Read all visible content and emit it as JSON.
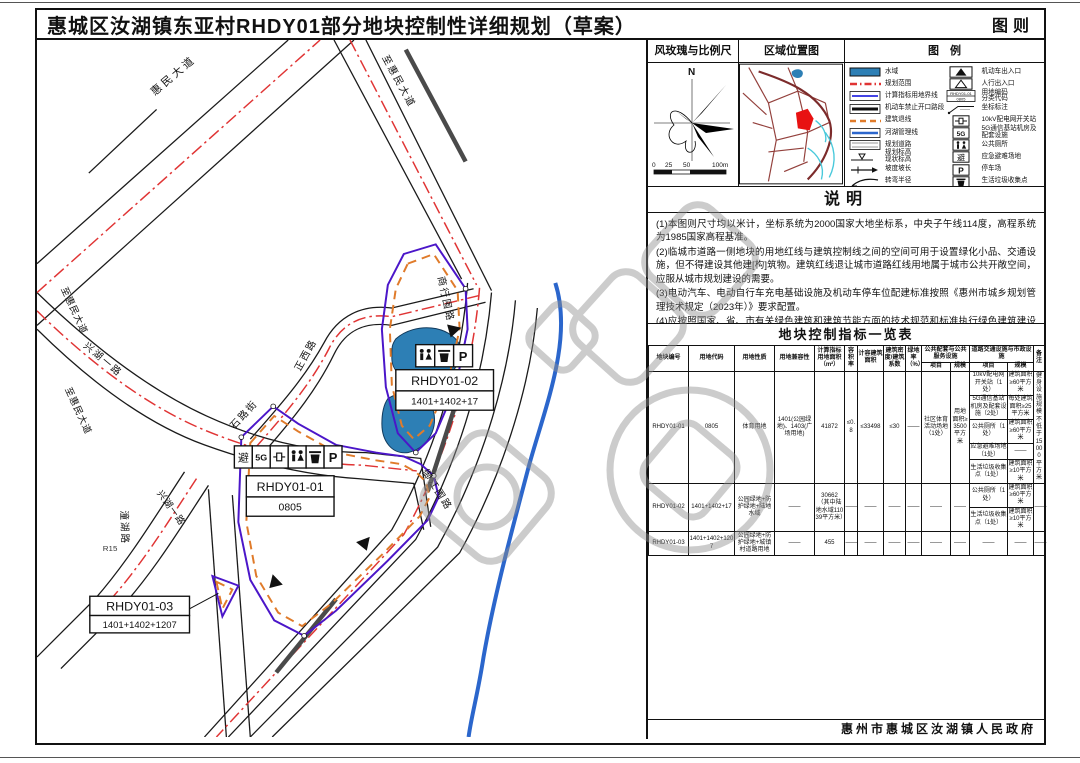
{
  "title": "惠城区汝湖镇东亚村RHDY01部分地块控制性详细规划（草案）",
  "sheet_label": "图则",
  "footer": "惠州市惠城区汝湖镇人民政府",
  "panels": {
    "windrose_title": "风玫瑰与比例尺",
    "location_title": "区域位置图",
    "legend_title": "图　例",
    "north_label": "N",
    "scale_ticks": [
      "0",
      "25",
      "50",
      "100m"
    ]
  },
  "legend": {
    "left": [
      {
        "label": "水域"
      },
      {
        "label": "规划范围"
      },
      {
        "label": "计算指标用地界线"
      },
      {
        "label": "机动车禁止开口路段"
      },
      {
        "label": "建筑退线"
      },
      {
        "label": "河湖管理线"
      },
      {
        "label": "规划道路"
      },
      {
        "label": "规划标高\n现状标高"
      },
      {
        "label": "坡度坡长"
      },
      {
        "label": "转弯半径"
      }
    ],
    "right": [
      {
        "label": "机动车出入口"
      },
      {
        "label": "人行出入口"
      },
      {
        "label": "用地编码\n分类代码"
      },
      {
        "label": "坐标标注"
      },
      {
        "label": "10kV配电网开关站"
      },
      {
        "label": "5G通信基站机房及\n配套设施"
      },
      {
        "label": "公共厕所"
      },
      {
        "label": "应急避难场地"
      },
      {
        "label": "停车场"
      },
      {
        "label": "生活垃圾收集点"
      }
    ],
    "samples": {
      "code_top": "RHDY01-01",
      "code_bottom": "0805"
    }
  },
  "notes": {
    "title": "说明",
    "items": [
      "(1)本图则尺寸均以米计，坐标系统为2000国家大地坐标系，中央子午线114度，高程系统为1985国家高程基准。",
      "(2)临城市道路一侧地块的用地红线与建筑控制线之间的空间可用于设置绿化小品、交通设施，但不得建设其他建[构]筑物。建筑红线退让城市道路红线用地属于城市公共开敞空间，应服从城市规划建设的需要。",
      "(3)电动汽车、电动自行车充电基础设施及机动车停车位配建标准按照《惠州市城乡规划管理技术规定（2023年）》要求配置。",
      "(4)应按照国家、省、市有关绿色建筑和建筑节能方面的技术规范和标准执行绿色建筑建设要求。"
    ]
  },
  "table": {
    "title": "地块控制指标一览表",
    "headers": {
      "no": "地块编号",
      "code": "用地代码",
      "use": "用地性质",
      "compat": "用地兼容性",
      "area": "计算指标用地面积（m²）",
      "far": "容积率",
      "gfa": "计容建筑面积",
      "density": "建筑密度/建筑系数",
      "green": "绿地率（%）",
      "pub": "公共配套与公共服务设施",
      "muni": "道路交通设施与市政设施",
      "item": "项目",
      "scale": "规模",
      "remark": "备注"
    },
    "row1": {
      "no": "RHDY01-01",
      "code": "0805",
      "use": "体育用地",
      "compat": "1401(公园绿地)、1403(广场用地)",
      "area": "41872",
      "far": "≤0.8",
      "gfa": "≤33498",
      "density": "≤30",
      "green": "——",
      "pub_item": "社区体育活动场地（1处）",
      "pub_scale": "用地面积≥3500平方米",
      "muni": [
        {
          "item": "10kV配电网开关站（1处）",
          "scale": "建筑面积≥60平方米"
        },
        {
          "item": "5G通信基站机房及配套设施（2处）",
          "scale": "每处建筑面积≥25平方米"
        },
        {
          "item": "公共厕所（1处）",
          "scale": "建筑面积≥60平方米"
        },
        {
          "item": "应急避难场地（1处）",
          "scale": "——"
        },
        {
          "item": "生活垃圾收集点（1处）",
          "scale": "建筑面积≥10平方米"
        }
      ],
      "remark": "健身设施规模不低于15000平方米"
    },
    "row2": {
      "no": "RHDY01-02",
      "code": "1401+1402+17",
      "use": "公园绿地+防护绿地+陆地水域",
      "compat": "——",
      "area": "30662（其中陆地水域11039平方米）",
      "far": "——",
      "gfa": "——",
      "density": "——",
      "green": "——",
      "pub_item": "——",
      "pub_scale": "——",
      "muni": [
        {
          "item": "公共厕所（1处）",
          "scale": "建筑面积≥60平方米"
        },
        {
          "item": "生活垃圾收集点（1处）",
          "scale": "建筑面积≥10平方米"
        }
      ],
      "remark": "——"
    },
    "row3": {
      "no": "RHDY01-03",
      "code": "1401+1402+1207",
      "use": "公园绿地+防护绿地+城镇村道路用地",
      "compat": "——",
      "area": "455",
      "far": "——",
      "gfa": "——",
      "density": "——",
      "green": "——",
      "pub_item": "——",
      "pub_scale": "——",
      "muni_item": "——",
      "muni_scale": "——",
      "remark": "——"
    }
  },
  "map": {
    "road_labels": {
      "huimin": "惠民大道",
      "to_huimin_right": "至惠民大道",
      "to_huimin_left1": "至惠民大道",
      "to_huimin_left2": "至惠民大道",
      "xinghu1": "兴湖一路",
      "xinghu2": "兴湖一路",
      "zhengxi": "正西路",
      "shilu": "石路街",
      "shanghang": "商行围路",
      "yujiang": "御江围路",
      "tonghu": "潼湖路",
      "r15": "R15"
    },
    "parcels": [
      {
        "id": "RHDY01-01",
        "code": "0805"
      },
      {
        "id": "RHDY01-02",
        "code": "1401+1402+17"
      },
      {
        "id": "RHDY01-03",
        "code": "1401+1402+1207"
      }
    ],
    "icons": {
      "shelter": "避",
      "fiveg": "5G",
      "parking": "P"
    }
  }
}
